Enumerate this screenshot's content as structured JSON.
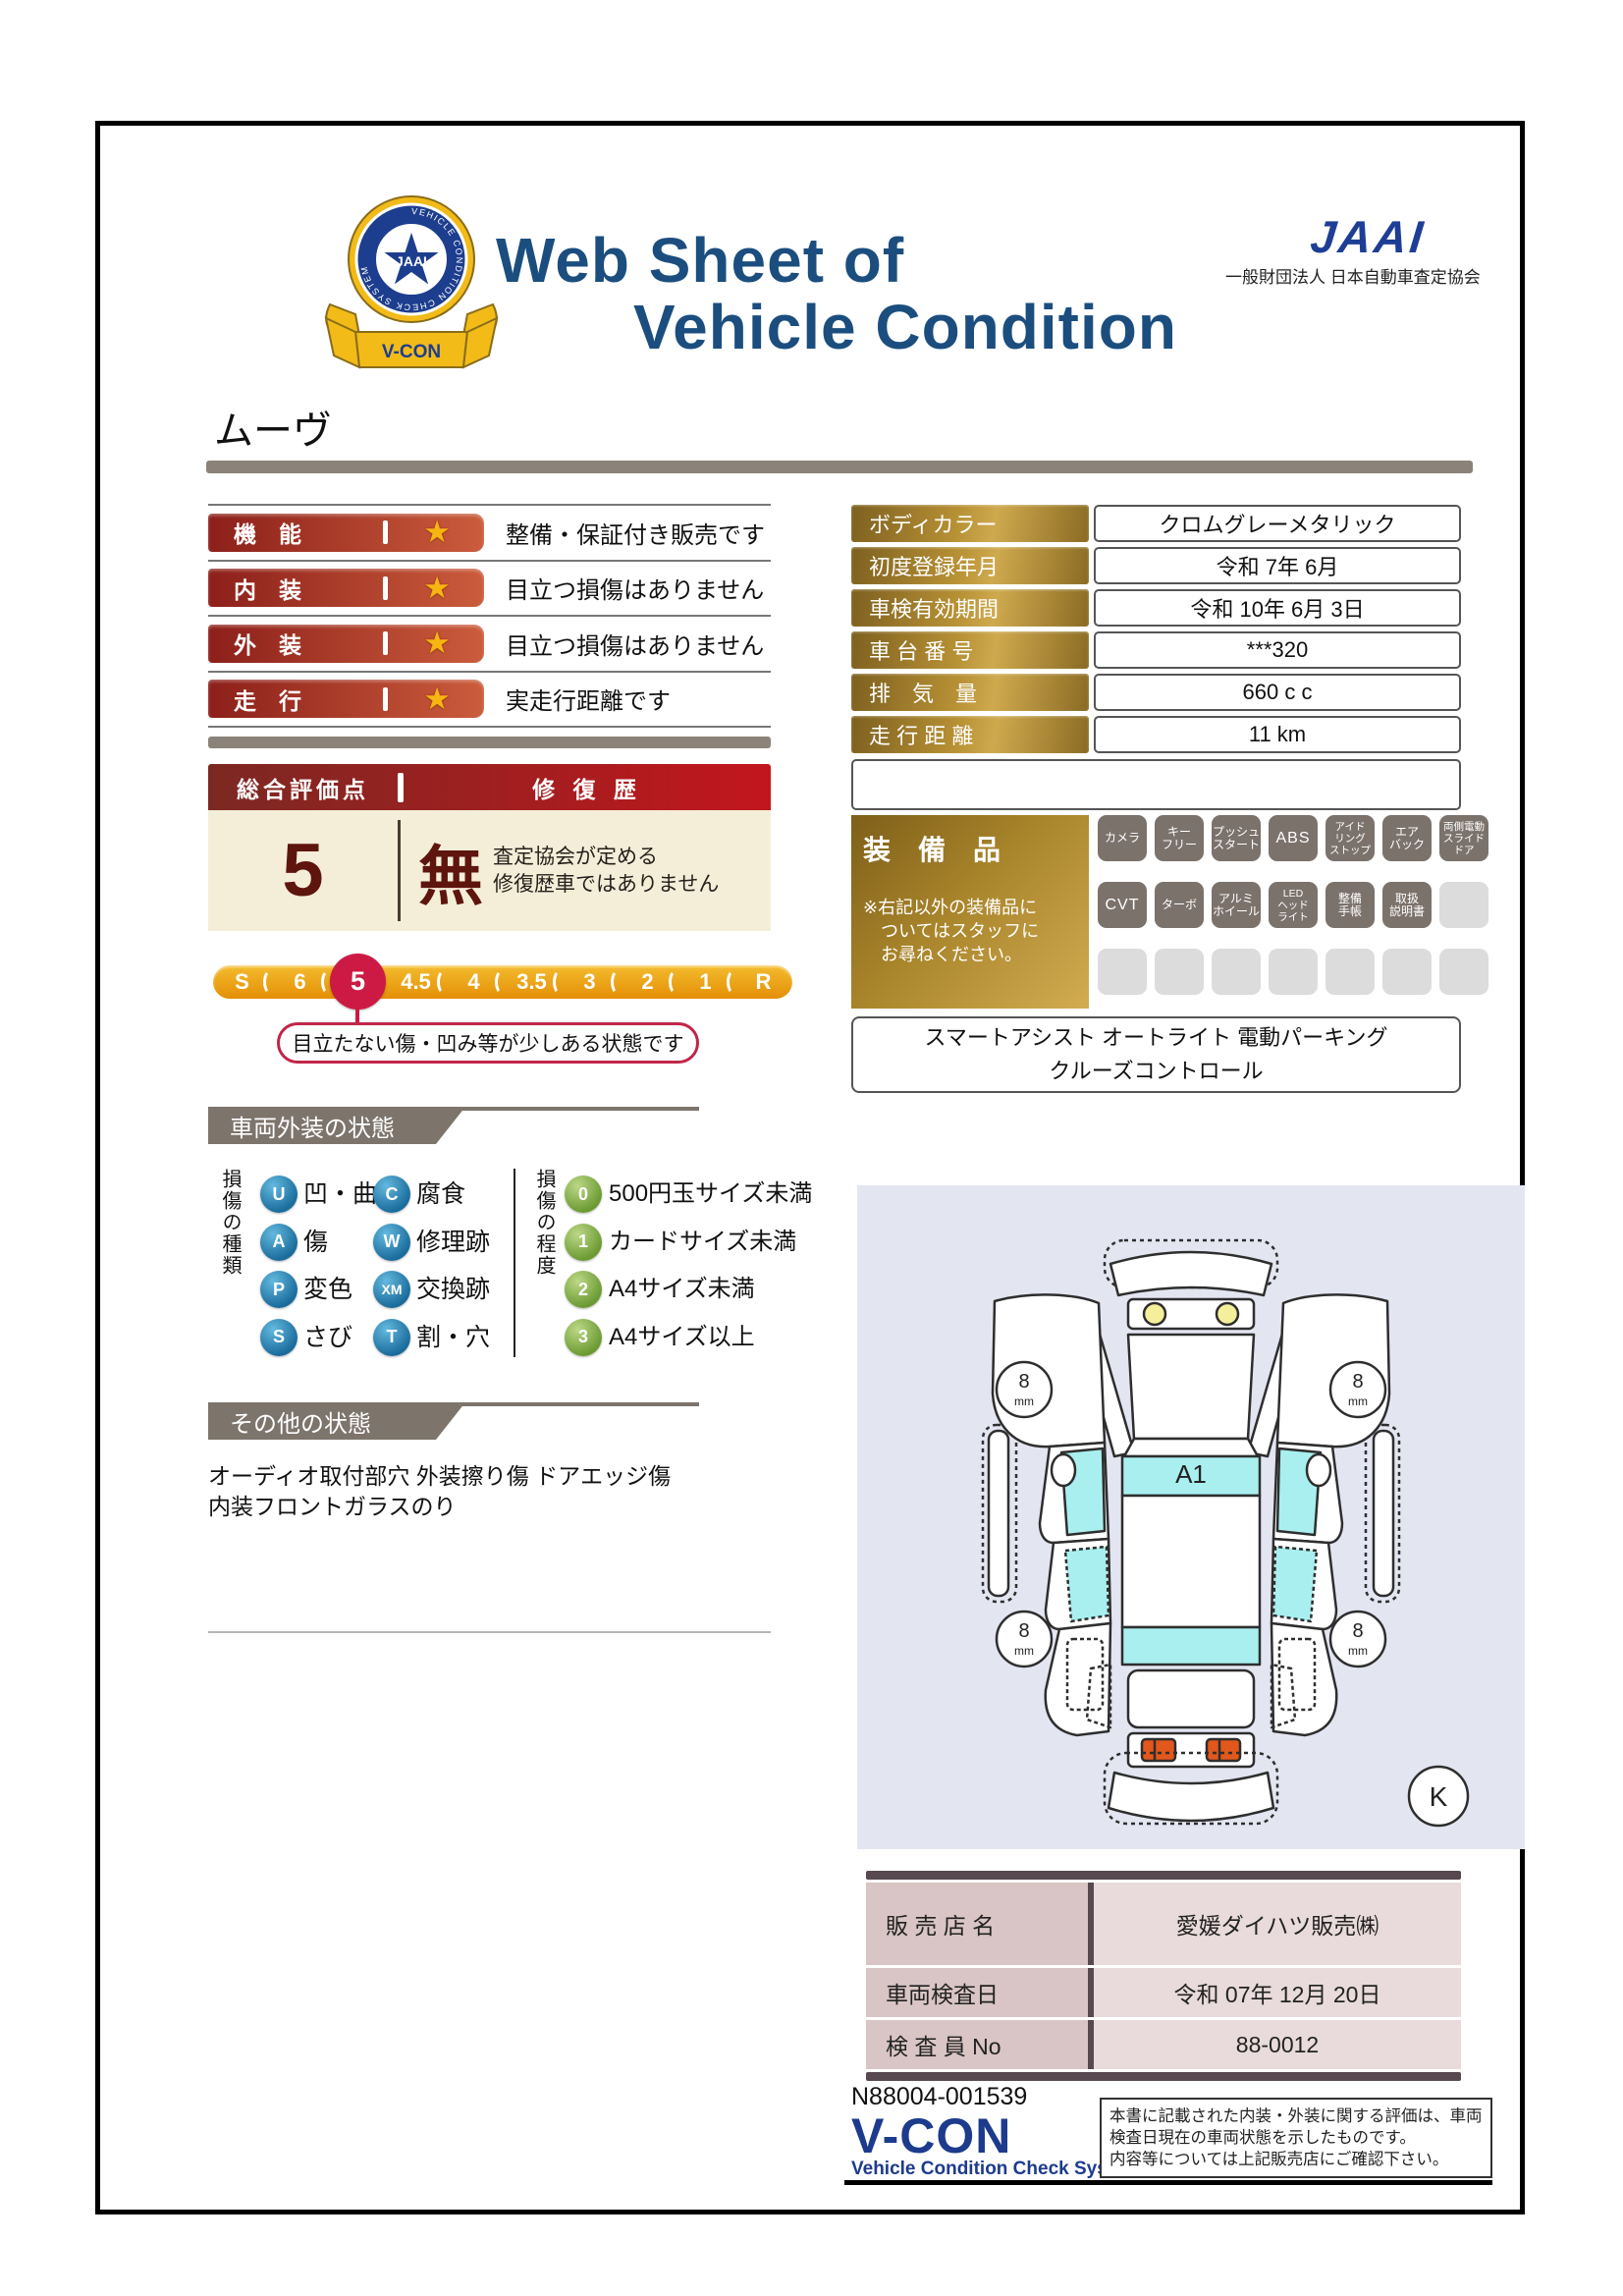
{
  "colors": {
    "navy": "#1b4e7f",
    "brand_blue": "#1d3b8d",
    "bar_red": "#8c1f1a",
    "accent_red": "#cd1a44",
    "gold": "#b89135",
    "cream": "#f4eed9",
    "badge_grey": "#7b726c",
    "taupe": "#7d746c"
  },
  "header": {
    "title_line1": "Web Sheet of",
    "title_line2": "Vehicle Condition",
    "jaai_logo": "JAAI",
    "jaai_org": "一般財団法人 日本自動車査定協会",
    "emblem": {
      "ring_text": "VEHICLE CONDITION CHECK SYSTEM",
      "center_text": "JAAI",
      "ribbon_text": "V-CON"
    }
  },
  "vehicle_name": "ムーヴ",
  "ratings": [
    {
      "label": "機　能",
      "comment": "整備・保証付き販売です"
    },
    {
      "label": "内　装",
      "comment": "目立つ損傷はありません"
    },
    {
      "label": "外　装",
      "comment": "目立つ損傷はありません"
    },
    {
      "label": "走　行",
      "comment": "実走行距離です"
    }
  ],
  "overall": {
    "header_left": "総合評価点",
    "header_right": "修 復 歴",
    "score": "5",
    "repair": "無",
    "repair_note_line1": "査定協会が定める",
    "repair_note_line2": "修復歴車ではありません"
  },
  "scale": {
    "values": [
      "S",
      "6",
      "5",
      "4.5",
      "4",
      "3.5",
      "3",
      "2",
      "1",
      "R"
    ],
    "selected": "5",
    "callout": "目立たない傷・凹み等が少しある状態です"
  },
  "info_table": {
    "rows": [
      {
        "label": "ボディカラー",
        "value": "クロムグレーメタリック"
      },
      {
        "label": "初度登録年月",
        "value": "令和 7年 6月"
      },
      {
        "label": "車検有効期間",
        "value": "令和 10年 6月 3日"
      },
      {
        "label": "車 台 番 号",
        "value": "***320"
      },
      {
        "label": "排　気　量",
        "value": "660 c c"
      },
      {
        "label": "走 行 距 離",
        "value": "11 km"
      }
    ]
  },
  "equipment": {
    "title": "装　備　品",
    "note_lines": [
      "※右記以外の装備品に",
      "　ついてはスタッフに",
      "　お尋ねください。"
    ],
    "badge_rows": [
      [
        {
          "lines": [
            "カメラ"
          ],
          "active": true,
          "size": ""
        },
        {
          "lines": [
            "キー",
            "フリー"
          ],
          "active": true,
          "size": ""
        },
        {
          "lines": [
            "プッシュ",
            "スタート"
          ],
          "active": true,
          "size": ""
        },
        {
          "lines": [
            "ABS"
          ],
          "active": true,
          "size": "big"
        },
        {
          "lines": [
            "アイド",
            "リング",
            "ストップ"
          ],
          "active": true,
          "size": "tiny"
        },
        {
          "lines": [
            "エア",
            "バック"
          ],
          "active": true,
          "size": ""
        },
        {
          "lines": [
            "両側電動",
            "スライド",
            "ドア"
          ],
          "active": true,
          "size": "tiny"
        }
      ],
      [
        {
          "lines": [
            "CVT"
          ],
          "active": true,
          "size": "big"
        },
        {
          "lines": [
            "ターボ"
          ],
          "active": true,
          "size": ""
        },
        {
          "lines": [
            "アルミ",
            "ホイール"
          ],
          "active": true,
          "size": ""
        },
        {
          "lines": [
            "LED",
            "ヘッド",
            "ライト"
          ],
          "active": true,
          "size": "tiny"
        },
        {
          "lines": [
            "整備",
            "手帳"
          ],
          "active": true,
          "size": ""
        },
        {
          "lines": [
            "取扱",
            "説明書"
          ],
          "active": true,
          "size": ""
        },
        {
          "lines": [],
          "active": false,
          "size": ""
        }
      ],
      [
        {
          "lines": [],
          "active": false,
          "size": ""
        },
        {
          "lines": [],
          "active": false,
          "size": ""
        },
        {
          "lines": [],
          "active": false,
          "size": ""
        },
        {
          "lines": [],
          "active": false,
          "size": ""
        },
        {
          "lines": [],
          "active": false,
          "size": ""
        },
        {
          "lines": [],
          "active": false,
          "size": ""
        },
        {
          "lines": [],
          "active": false,
          "size": ""
        }
      ]
    ],
    "extra_lines": [
      "スマートアシスト オートライト 電動パーキング",
      "クルーズコントロール"
    ]
  },
  "exterior_section": {
    "title": "車両外装の状態",
    "kind_title": "損傷の種類",
    "kinds_col1": [
      {
        "code": "U",
        "label": "凹・曲"
      },
      {
        "code": "A",
        "label": "傷"
      },
      {
        "code": "P",
        "label": "変色"
      },
      {
        "code": "S",
        "label": "さび"
      }
    ],
    "kinds_col2": [
      {
        "code": "C",
        "label": "腐食"
      },
      {
        "code": "W",
        "label": "修理跡"
      },
      {
        "code": "XM",
        "label": "交換跡"
      },
      {
        "code": "T",
        "label": "割・穴"
      }
    ],
    "degree_title": "損傷の程度",
    "degrees": [
      {
        "code": "0",
        "label": "500円玉サイズ未満"
      },
      {
        "code": "1",
        "label": "カードサイズ未満"
      },
      {
        "code": "2",
        "label": "A4サイズ未満"
      },
      {
        "code": "3",
        "label": "A4サイズ以上"
      }
    ]
  },
  "other_section": {
    "title": "その他の状態",
    "lines": [
      "オーディオ取付部穴 外装擦り傷 ドアエッジ傷",
      "内装フロントガラスのり"
    ]
  },
  "diagram": {
    "damage_marker": "A1",
    "wheel_size": "8",
    "wheel_unit": "mm",
    "corner_mark": "K"
  },
  "dealer_table": {
    "rows": [
      {
        "label": "販 売 店 名",
        "value": "愛媛ダイハツ販売㈱"
      },
      {
        "label": "車両検査日",
        "value": "令和 07年 12月 20日"
      },
      {
        "label": "検 査 員 No",
        "value": "88-0012"
      }
    ]
  },
  "footer": {
    "serial": "N88004-001539",
    "brand": "V-CON",
    "brand_sub": "Vehicle Condition Check System",
    "disclaimer_lines": [
      "本書に記載された内装・外装に関する評価は、車両",
      "検査日現在の車両状態を示したものです。",
      "内容等については上記販売店にご確認下さい。"
    ]
  }
}
